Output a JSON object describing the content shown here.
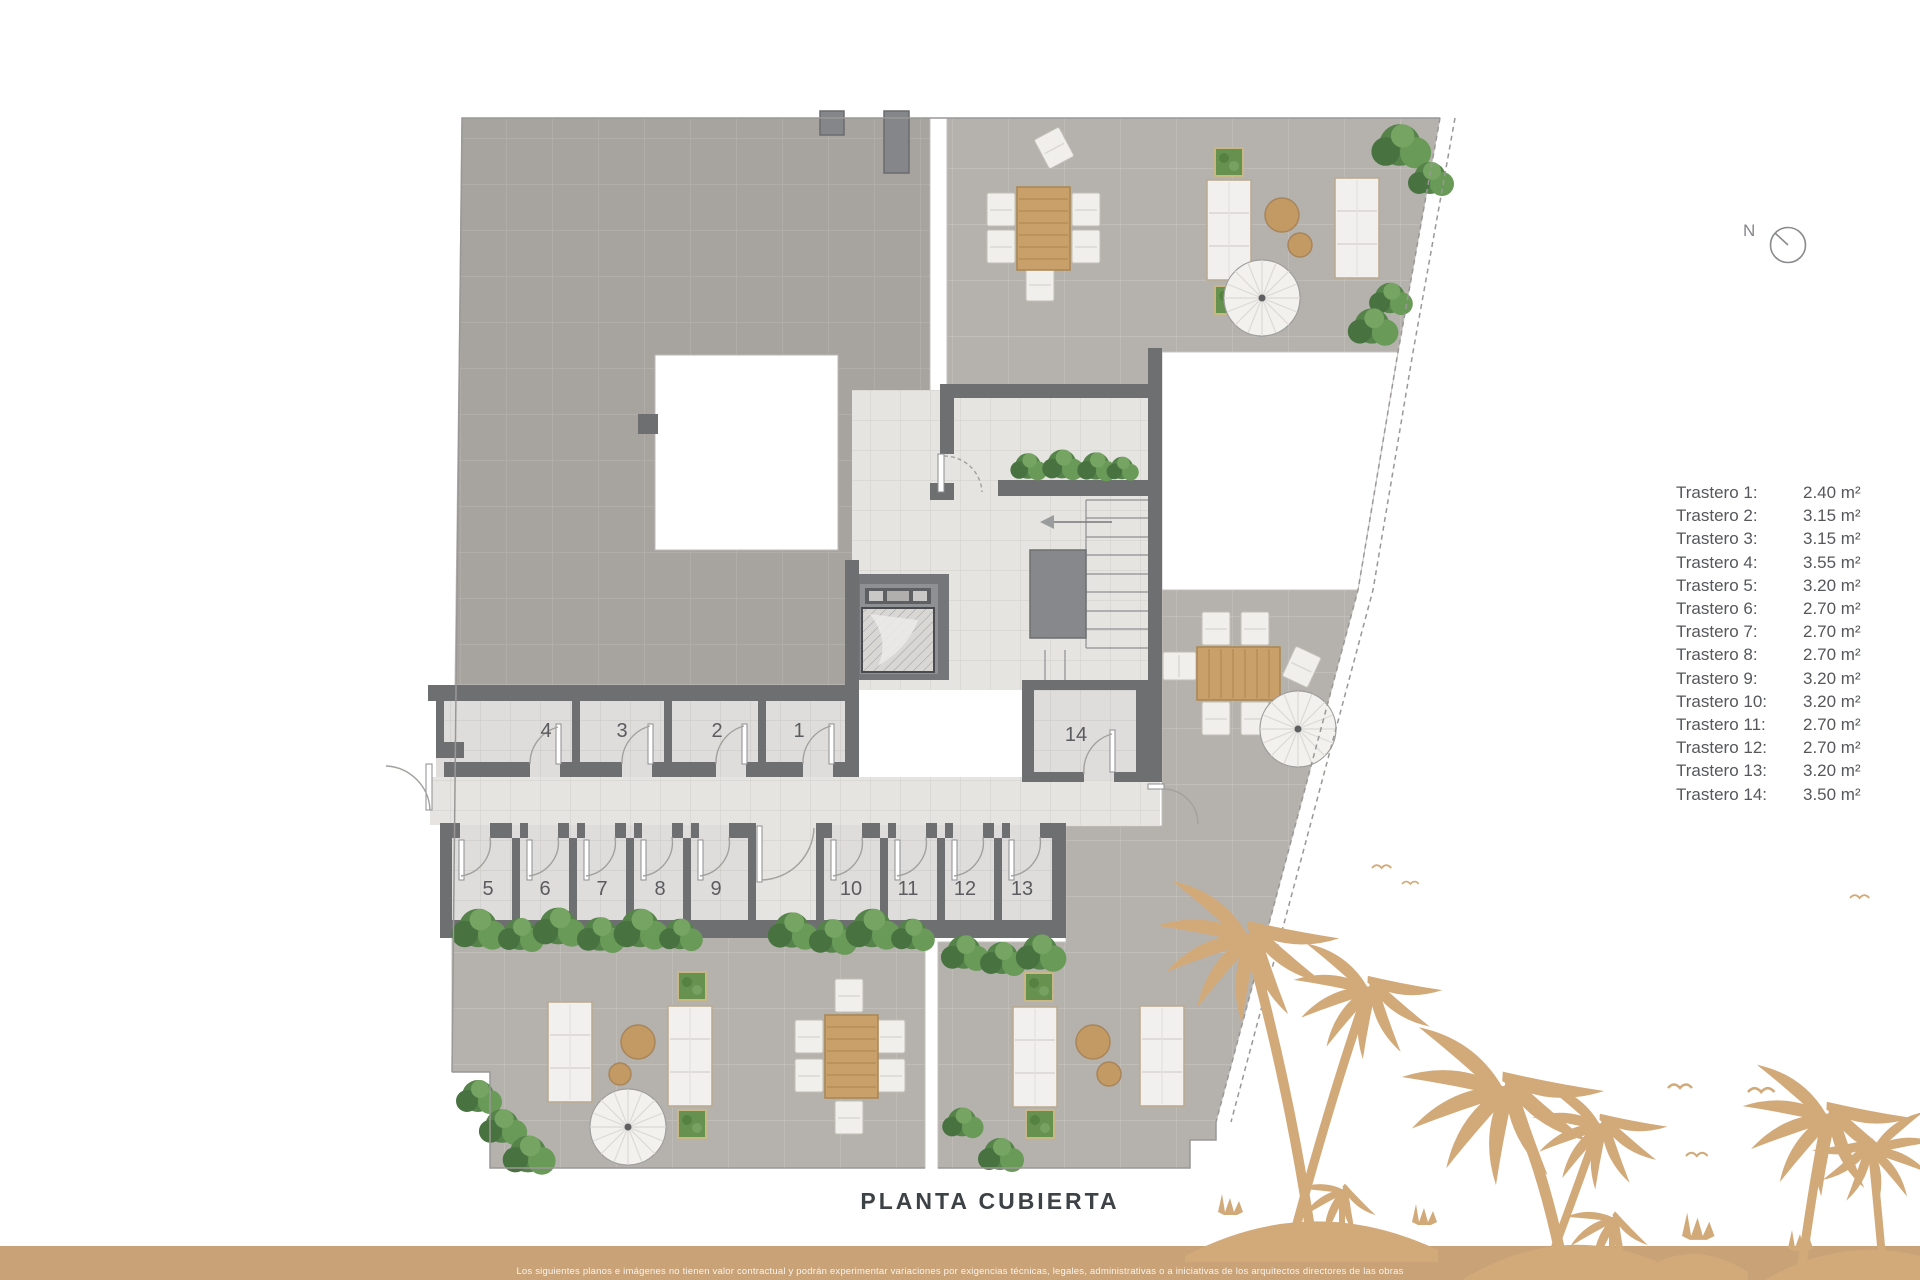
{
  "page": {
    "title": "PLANTA CUBIERTA"
  },
  "compass": {
    "north_label": "N"
  },
  "legend": {
    "items": [
      {
        "name": "Trastero 1:",
        "area": "2.40 m²"
      },
      {
        "name": "Trastero 2:",
        "area": "3.15 m²"
      },
      {
        "name": "Trastero 3:",
        "area": "3.15 m²"
      },
      {
        "name": "Trastero 4:",
        "area": "3.55 m²"
      },
      {
        "name": "Trastero 5:",
        "area": "3.20 m²"
      },
      {
        "name": "Trastero 6:",
        "area": "2.70 m²"
      },
      {
        "name": "Trastero 7:",
        "area": "2.70 m²"
      },
      {
        "name": "Trastero 8:",
        "area": "2.70 m²"
      },
      {
        "name": "Trastero 9:",
        "area": "3.20 m²"
      },
      {
        "name": "Trastero 10:",
        "area": "3.20 m²"
      },
      {
        "name": "Trastero 11:",
        "area": "2.70 m²"
      },
      {
        "name": "Trastero 12:",
        "area": "2.70 m²"
      },
      {
        "name": "Trastero 13:",
        "area": "3.20 m²"
      },
      {
        "name": "Trastero 14:",
        "area": "3.50 m²"
      }
    ]
  },
  "plan": {
    "room_labels": [
      "1",
      "2",
      "3",
      "4",
      "5",
      "6",
      "7",
      "8",
      "9",
      "10",
      "11",
      "12",
      "13",
      "14"
    ]
  },
  "footer": {
    "disclaimer": "Los siguientes planos e imágenes no tienen valor contractual y podrán experimentar variaciones por exigencias técnicas, legales, administrativas o a iniciativas de los arquitectos directores de las obras"
  },
  "colors": {
    "accent_gold": "#c9a277",
    "palm_tan": "#d2aa7a",
    "wall_gray": "#6e6f71",
    "roof_tile": "#a7a4a0",
    "terrace_tile": "#b5b2ad"
  }
}
